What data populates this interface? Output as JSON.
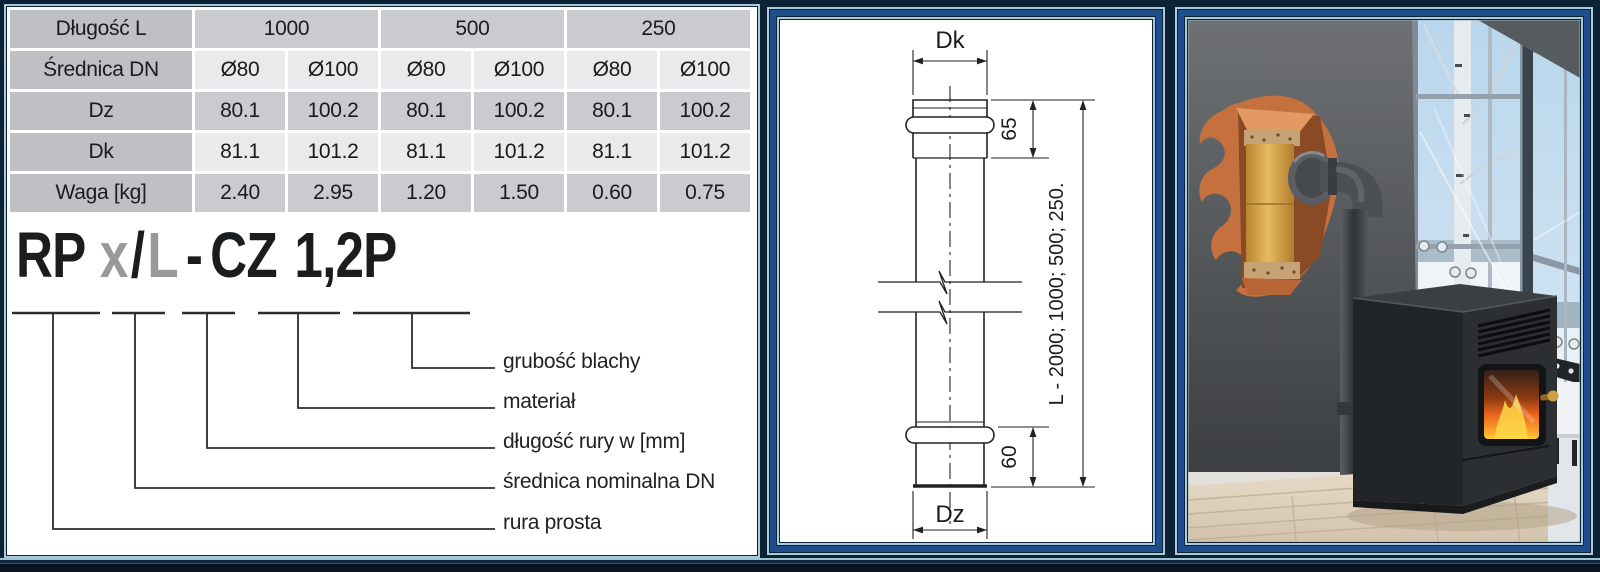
{
  "table": {
    "header_row": {
      "label": "Długość L",
      "values": [
        "1000",
        "500",
        "250"
      ]
    },
    "rows": [
      {
        "label": "Średnica DN",
        "values": [
          "Ø80",
          "Ø100",
          "Ø80",
          "Ø100",
          "Ø80",
          "Ø100"
        ]
      },
      {
        "label": "Dz",
        "values": [
          "80.1",
          "100.2",
          "80.1",
          "100.2",
          "80.1",
          "100.2"
        ]
      },
      {
        "label": "Dk",
        "values": [
          "81.1",
          "101.2",
          "81.1",
          "101.2",
          "81.1",
          "101.2"
        ]
      },
      {
        "label": "Waga [kg]",
        "values": [
          "2.40",
          "2.95",
          "1.20",
          "1.50",
          "0.60",
          "0.75"
        ]
      }
    ]
  },
  "product_code": {
    "rp": "RP",
    "x": "x",
    "slash": "/",
    "l": "L",
    "dash": "-",
    "cz": "CZ",
    "size": "1,2P"
  },
  "code_legend": [
    "grubość blachy",
    "materiał",
    "długość rury w [mm]",
    "średnica nominalna DN",
    "rura prosta"
  ],
  "drawing": {
    "dim_top": "Dk",
    "dim_bottom": "Dz",
    "dim_socket": "65",
    "dim_spigot": "60",
    "dim_length": "L - 2000; 1000; 500; 250."
  },
  "colors": {
    "frame_navy": "#0e2236",
    "frame_lightblue": "#a9cbd9",
    "frame_blue": "#1f4e8a",
    "table_header_gray": "#bec0c4",
    "table_row_gray": "#c9cbcf",
    "table_row_light": "#e9eaec",
    "cutaway_orange": "#c4703f",
    "flue_yellow": "#d9a84a",
    "fire_orange": "#ea641c"
  }
}
